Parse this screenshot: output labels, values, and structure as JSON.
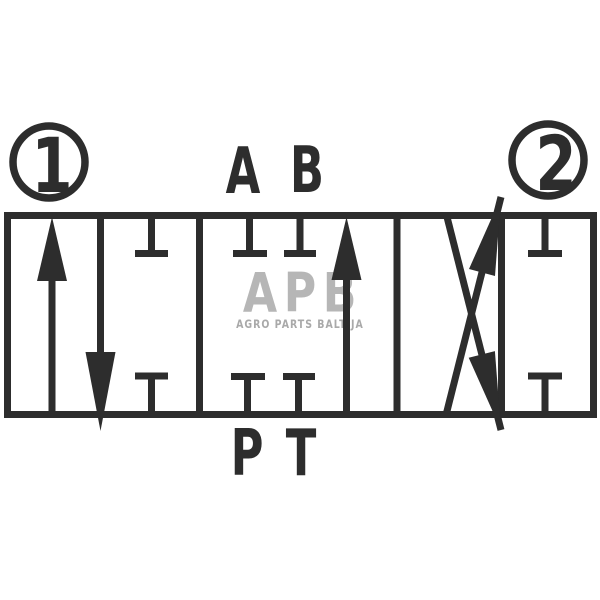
{
  "diagram": {
    "type": "hydraulic directional control valve schematic",
    "spool_left_number": "1",
    "spool_right_number": "2",
    "port_top_left": "A",
    "port_top_right": "B",
    "port_bottom_left": "P",
    "port_bottom_right": "T"
  },
  "watermark": {
    "logo": "APB",
    "caption": "AGRO PARTS BALTIJA"
  },
  "colors": {
    "line": "#2d2d2d",
    "background": "#ffffff",
    "watermark_logo": "#b6b6b6",
    "watermark_caption": "#a9a9a9"
  }
}
